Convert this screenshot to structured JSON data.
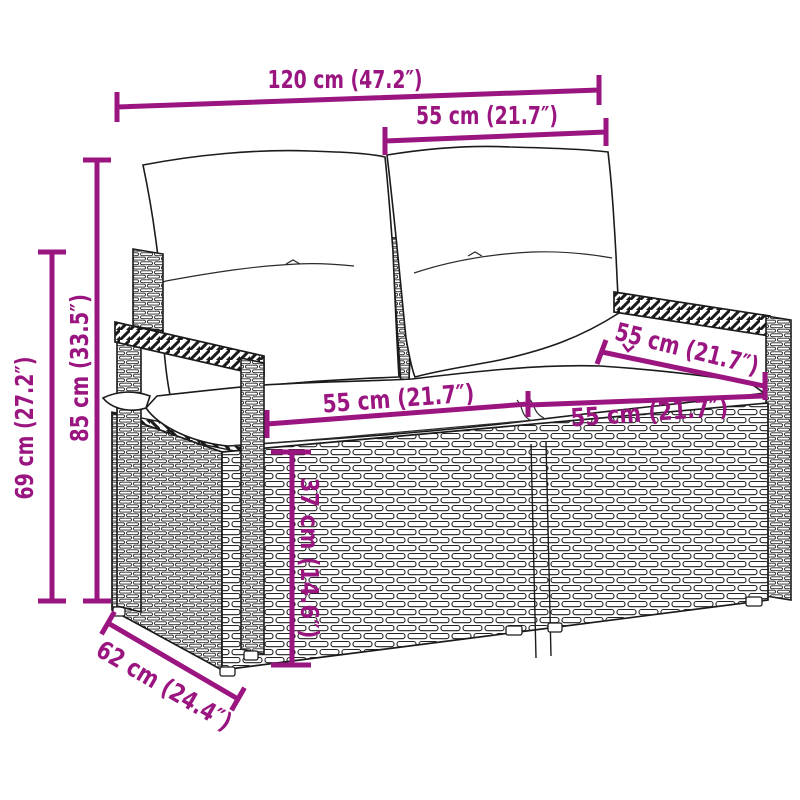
{
  "colors": {
    "accent": "#9A1580",
    "line_art": "#1b1b1b",
    "background": "#ffffff"
  },
  "illustration": {
    "subject": "2-seater poly rattan garden bench with back and seat cushions"
  },
  "dimensions": {
    "total_width": "120 cm (47.2″)",
    "backrest_width": "55 cm (21.7″)",
    "back_height": "85 cm (33.5″)",
    "arm_height": "69 cm (27.2″)",
    "seat_width_left": "55 cm (21.7″)",
    "seat_depth": "55 cm (21.7″)",
    "seat_width_right": "55 cm (21.7″)",
    "seat_height": "37 cm (14.6″)",
    "base_depth": "62 cm (24.4″)"
  }
}
